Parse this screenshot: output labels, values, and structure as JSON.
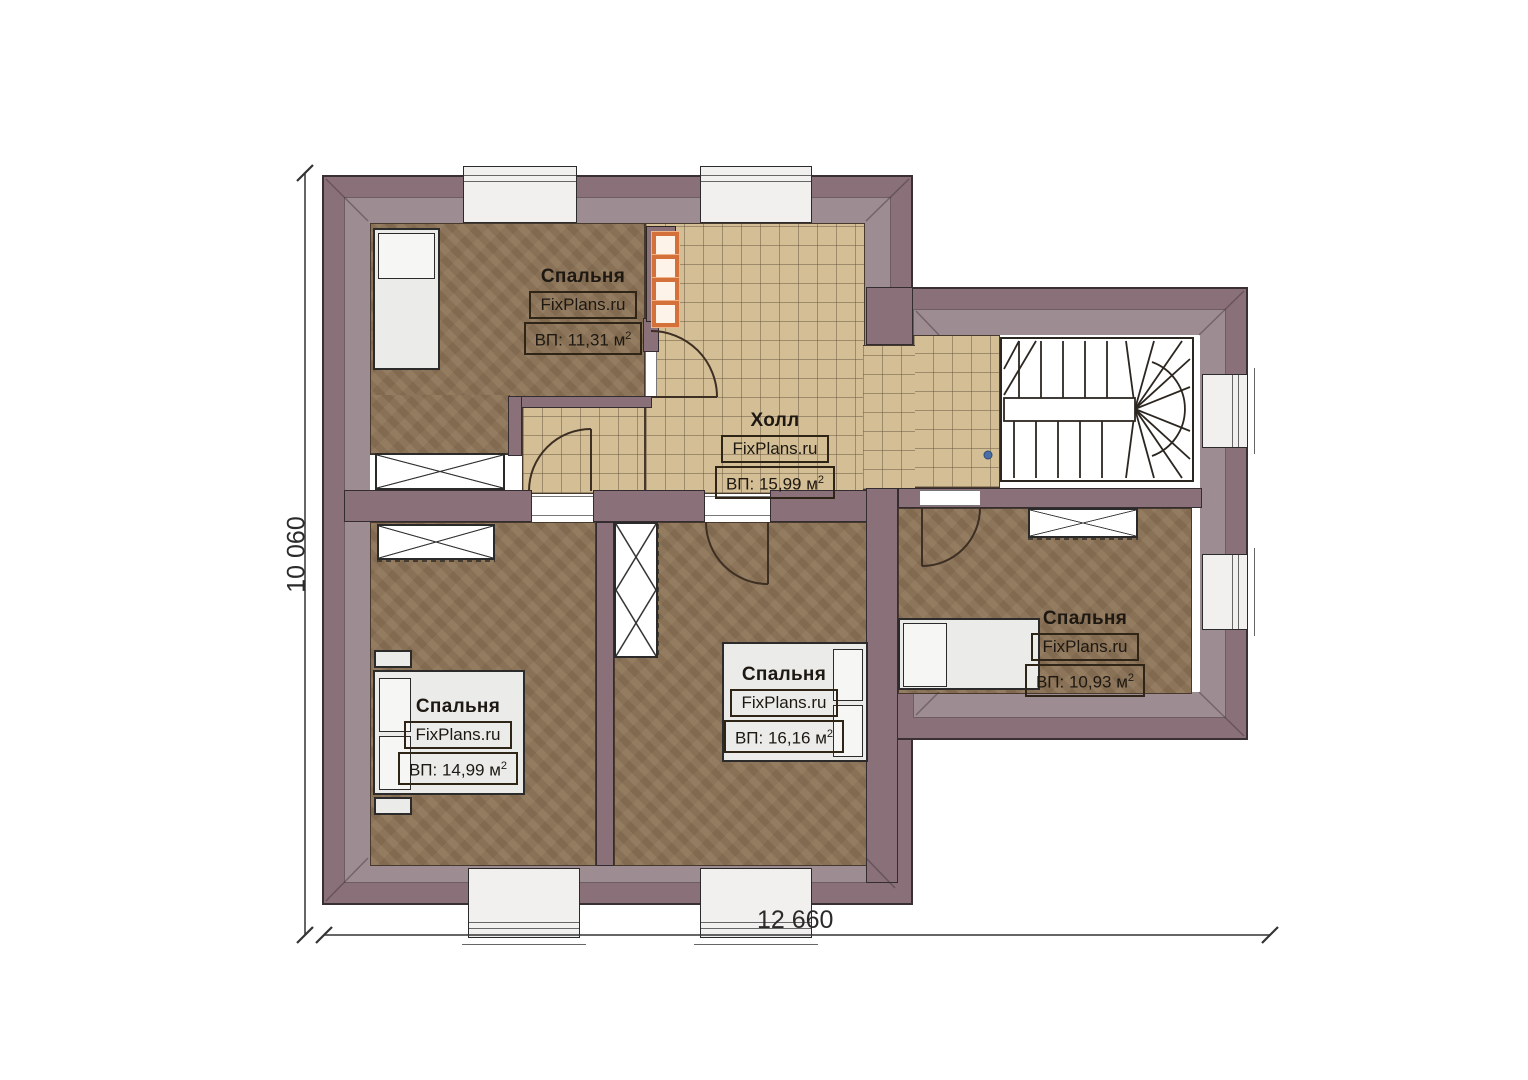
{
  "plan": {
    "type": "second-floor apartment plan",
    "dim_bottom": "12 660",
    "dim_left": "10 060",
    "rooms": [
      {
        "name": "Спальня",
        "brand": "FixPlans.ru",
        "area": "ВП: 11,31 м",
        "sup": "2"
      },
      {
        "name": "Холл",
        "brand": "FixPlans.ru",
        "area": "ВП: 15,99 м",
        "sup": "2"
      },
      {
        "name": "Спальня",
        "brand": "FixPlans.ru",
        "area": "ВП: 14,99 м",
        "sup": "2"
      },
      {
        "name": "Спальня",
        "brand": "FixPlans.ru",
        "area": "ВП: 16,16 м",
        "sup": "2"
      },
      {
        "name": "Спальня",
        "brand": "FixPlans.ru",
        "area": "ВП: 10,93 м",
        "sup": "2"
      }
    ],
    "colors": {
      "wall": "#8a7078",
      "band": "#9d8c92",
      "tile": "#d3be95",
      "floor": "#8c7356",
      "flue": "#d4713a"
    }
  }
}
